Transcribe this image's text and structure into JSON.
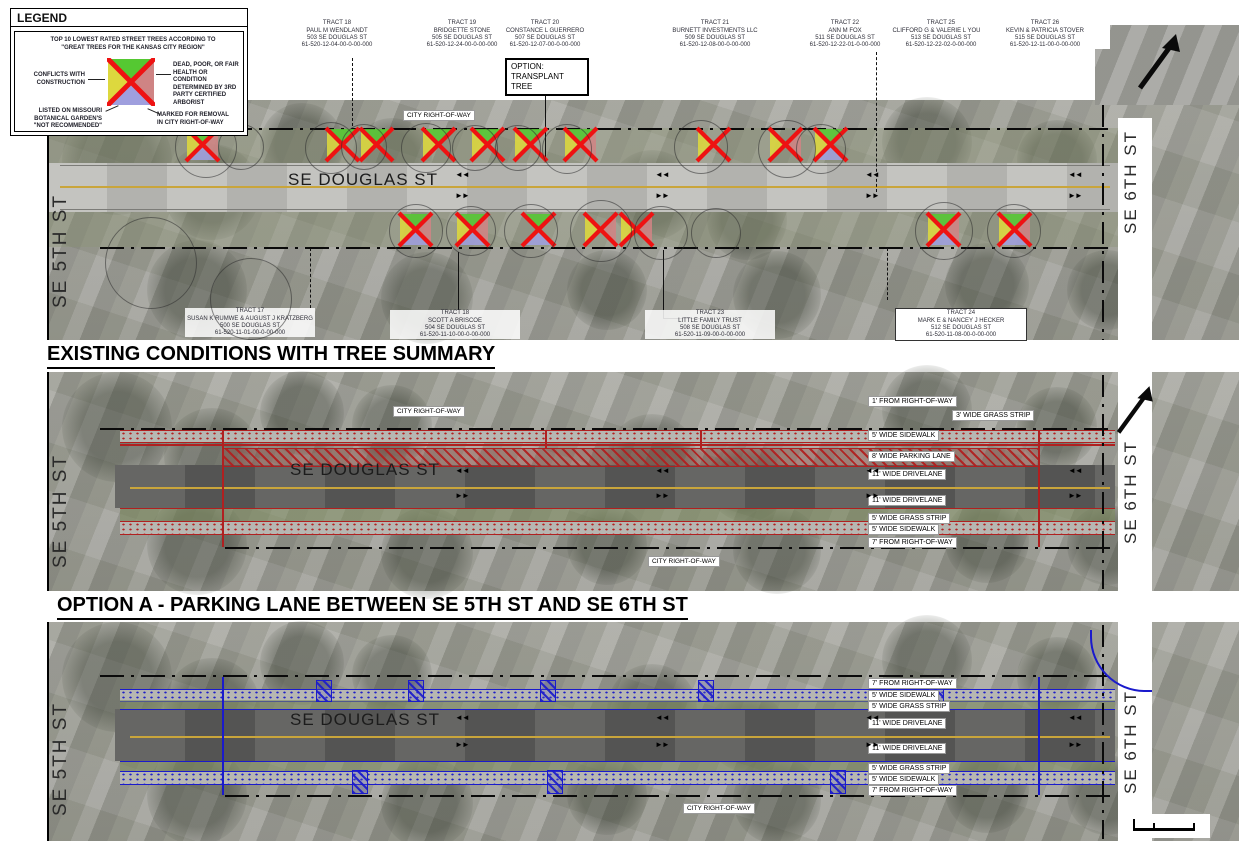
{
  "legend": {
    "title": "LEGEND",
    "note": "TOP 10 LOWEST RATED STREET TREES ACCORDING TO \"GREAT TREES FOR THE KANSAS CITY REGION\"",
    "conflicts": "CONFLICTS WITH CONSTRUCTION",
    "dead_poor": "DEAD, POOR, OR FAIR HEALTH OR CONDITION DETERMINED BY 3RD PARTY CERTIFIED ARBORIST",
    "not_recommended": "LISTED ON MISSOURI BOTANICAL GARDEN'S \"NOT RECOMMENDED\"",
    "marked_removal": "MARKED FOR REMOVAL IN CITY RIGHT-OF-WAY"
  },
  "titles": {
    "panel1": "EXISTING CONDITIONS WITH TREE SUMMARY",
    "panel2": "OPTION A - PARKING LANE BETWEEN SE 5TH ST AND SE 6TH ST"
  },
  "streets": {
    "left": "SE 5TH ST",
    "right": "SE 6TH ST",
    "main": "SE DOUGLAS ST",
    "row": "CITY RIGHT-OF-WAY"
  },
  "option_box": {
    "line1": "OPTION:",
    "line2": "TRANSPLANT",
    "line3": "TREE"
  },
  "lane_arrows": {
    "left": "◄◄",
    "right": "►►"
  },
  "tracts_top": [
    {
      "tract": "TRACT 18",
      "owner": "PAUL M WENDLANDT",
      "address": "503 SE DOUGLAS ST",
      "parcel": "61-520-12-04-00-0-00-000"
    },
    {
      "tract": "TRACT 19",
      "owner": "BRIDGETTE STONE",
      "address": "505 SE DOUGLAS ST",
      "parcel": "61-520-12-24-00-0-00-000"
    },
    {
      "tract": "TRACT 20",
      "owner": "CONSTANCE L GUERRERO",
      "address": "507 SE DOUGLAS ST",
      "parcel": "61-520-12-07-00-0-00-000"
    },
    {
      "tract": "TRACT 21",
      "owner": "BURNETT INVESTMENTS LLC",
      "address": "509 SE DOUGLAS ST",
      "parcel": "61-520-12-08-00-0-00-000"
    },
    {
      "tract": "TRACT 22",
      "owner": "ANN M FOX",
      "address": "511 SE DOUGLAS ST",
      "parcel": "61-520-12-22-01-0-00-000"
    },
    {
      "tract": "TRACT 25",
      "owner": "CLIFFORD G & VALERIE L YOUNG",
      "address": "513 SE DOUGLAS ST",
      "parcel": "61-520-12-22-02-0-00-000"
    },
    {
      "tract": "TRACT 26",
      "owner": "KEVIN & PATRICIA STOVER",
      "address": "515 SE DOUGLAS ST",
      "parcel": "61-520-12-11-00-0-00-000"
    }
  ],
  "tracts_bottom": [
    {
      "tract": "TRACT 17",
      "owner": "SUSAN K RUMWE & AUGUST J KRATZBERG",
      "address": "500 SE DOUGLAS ST",
      "parcel": "61-520-11-01-00-0-00-000"
    },
    {
      "tract": "TRACT 18",
      "owner": "SCOTT A BRISCOE",
      "address": "504 SE DOUGLAS ST",
      "parcel": "61-520-11-10-00-0-00-000"
    },
    {
      "tract": "TRACT 23",
      "owner": "LITTLE FAMILY TRUST",
      "address": "508 SE DOUGLAS ST",
      "parcel": "61-520-11-09-00-0-00-000"
    },
    {
      "tract": "TRACT 24",
      "owner": "MARK E & NANCEY J HECKER",
      "address": "512 SE DOUGLAS ST",
      "parcel": "61-520-11-08-00-0-00-000"
    }
  ],
  "panel2_labels": [
    "1' FROM RIGHT-OF-WAY",
    "3' WIDE GRASS STRIP",
    "5' WIDE SIDEWALK",
    "8' WIDE PARKING LANE",
    "11' WIDE DRIVELANE",
    "11' WIDE DRIVELANE",
    "5' WIDE GRASS STRIP",
    "5' WIDE SIDEWALK",
    "7' FROM RIGHT-OF-WAY"
  ],
  "panel3_labels": [
    "7' FROM RIGHT-OF-WAY",
    "5' WIDE SIDEWALK",
    "5' WIDE GRASS STRIP",
    "11' WIDE DRIVELANE",
    "11' WIDE DRIVELANE",
    "5' WIDE GRASS STRIP",
    "5' WIDE SIDEWALK",
    "7' FROM RIGHT-OF-WAY"
  ],
  "colors": {
    "marker_green": "#55c832",
    "marker_yellow": "#ddd83e",
    "marker_red": "#cf8484",
    "marker_blue": "#9f9fde",
    "marker_x": "#ee1212",
    "option_a_red": "#b02020",
    "option_b_blue": "#1a1acc",
    "centerline_yellow": "#c9a53b"
  },
  "tree_markers": {
    "size": 33,
    "x_color": "#ee1212",
    "items": [
      {
        "x": 186,
        "y": 128,
        "q": [
          "#55c832",
          "#cf8484",
          "#9f9fde",
          "#ddd83e"
        ]
      },
      {
        "x": 326,
        "y": 128,
        "q": [
          "#55c832",
          null,
          null,
          "#ddd83e"
        ]
      },
      {
        "x": 360,
        "y": 128,
        "q": [
          "#55c832",
          null,
          null,
          "#ddd83e"
        ]
      },
      {
        "x": 422,
        "y": 128,
        "q": [
          "#55c832",
          null,
          null,
          "#ddd83e"
        ]
      },
      {
        "x": 471,
        "y": 128,
        "q": [
          "#55c832",
          null,
          null,
          "#ddd83e"
        ]
      },
      {
        "x": 514,
        "y": 128,
        "q": [
          "#55c832",
          null,
          null,
          "#ddd83e"
        ]
      },
      {
        "x": 564,
        "y": 128,
        "q": [
          "#55c832",
          "#cf8484",
          null,
          "#ddd83e"
        ]
      },
      {
        "x": 697,
        "y": 128,
        "q": [
          null,
          null,
          null,
          "#ddd83e"
        ]
      },
      {
        "x": 769,
        "y": 128,
        "q": [
          null,
          "#cf8484",
          null,
          "#ddd83e"
        ]
      },
      {
        "x": 814,
        "y": 128,
        "q": [
          "#55c832",
          null,
          "#9f9fde",
          "#ddd83e"
        ]
      },
      {
        "x": 399,
        "y": 213,
        "q": [
          "#55c832",
          "#cf8484",
          "#9f9fde",
          "#ddd83e"
        ]
      },
      {
        "x": 456,
        "y": 213,
        "q": [
          "#55c832",
          "#cf8484",
          "#9f9fde",
          "#ddd83e"
        ]
      },
      {
        "x": 522,
        "y": 213,
        "q": [
          "#55c832",
          null,
          "#9f9fde",
          null
        ]
      },
      {
        "x": 584,
        "y": 213,
        "q": [
          null,
          "#cf8484",
          null,
          "#ddd83e"
        ]
      },
      {
        "x": 620,
        "y": 213,
        "q": [
          null,
          "#cf8484",
          null,
          "#ddd83e"
        ]
      },
      {
        "x": 927,
        "y": 213,
        "q": [
          "#55c832",
          "#cf8484",
          "#9f9fde",
          "#ddd83e"
        ]
      },
      {
        "x": 998,
        "y": 213,
        "q": [
          "#55c832",
          "#cf8484",
          "#9f9fde",
          "#ddd83e"
        ]
      }
    ]
  }
}
